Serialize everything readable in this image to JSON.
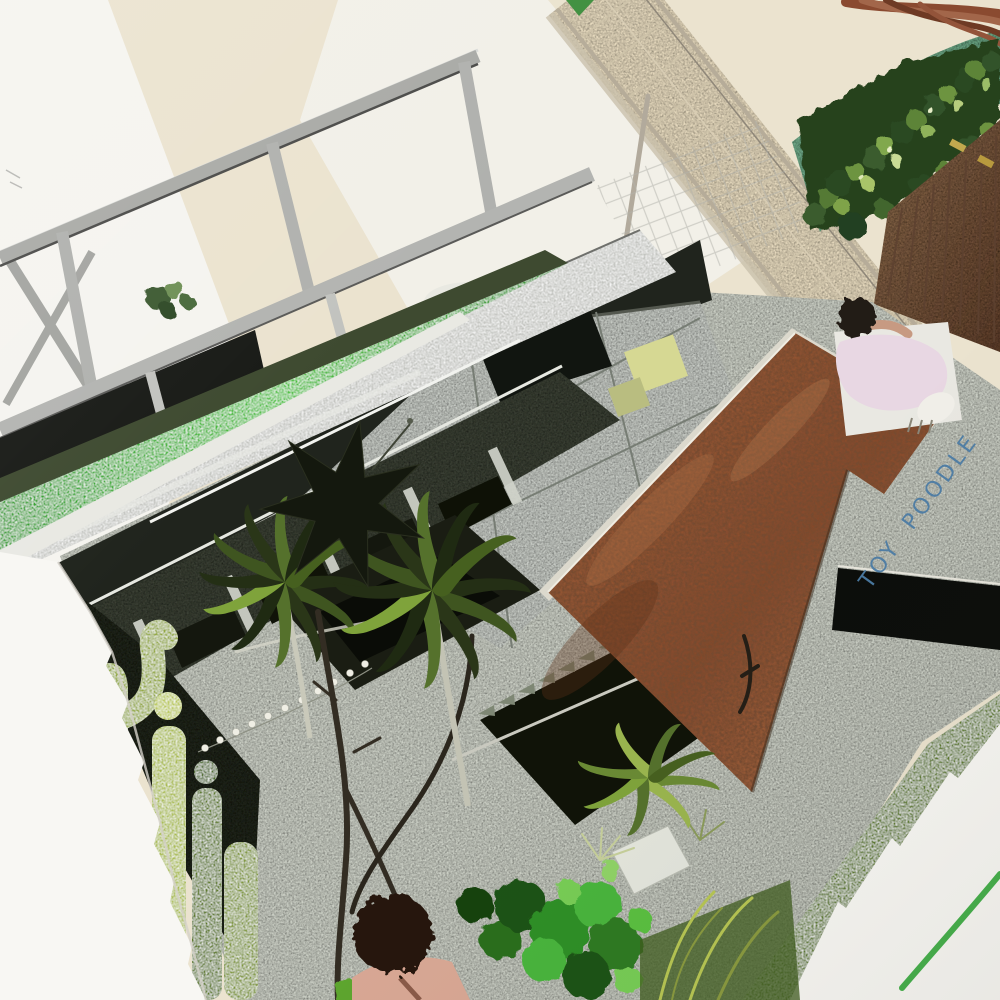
{
  "artwork": {
    "caption": {
      "text": "TOY POODLE",
      "color": "#4d7da6",
      "style": "handwritten blue marker rotated along the concrete path"
    },
    "medium": "photograph of a mixed-media collage painting on deckle-edged watercolor paper",
    "scene": "overhead view of a modernist house courtyard with a copper-rust roof, bright green stripe, steel frame, plants and two figures"
  },
  "figures": {
    "rooftop_figure": "person with dark hair wearing a pale pink shirt",
    "path_figure": "person with dark curly hair seen from above"
  },
  "flora": [
    "agave rosettes",
    "columnar cacti",
    "clipped hedge",
    "green bushes",
    "curved lawn band"
  ],
  "objects": [
    "seven-point star ornament",
    "string of lights",
    "chain-link lattice",
    "timber fence with brass hinges",
    "stone walkway",
    "stairwell with sawtooth steps"
  ],
  "palette": {
    "cream": "#ebe3cf",
    "white_wall": "#f5f4ef",
    "facade": "#f2f1ea",
    "walkway": "#e8dbbf",
    "lawn": "#69a581",
    "hedge": "#27421f",
    "wood": "#7b5238",
    "concrete": "#cbcfc5",
    "glass_deck": "#c6cac4",
    "dark_band": "#20241d",
    "wall_dark": "#3a4036",
    "pit_dark": "#101308",
    "fascia": "#c6c8c3",
    "steel": "#a9aaa6",
    "stripe": "#3eb332",
    "rust": "#96512f",
    "black_band": "#0c0e0b",
    "text_blue": "#4d7da6",
    "pink": "#e8d7e3",
    "skin": "#c79a82",
    "hair": "#241a12",
    "grass": "#5e7b2f",
    "stroke_green": "#47b04c",
    "pane_yellow": "#d6d893",
    "cactus": "#93a83e",
    "cactus_bright": "#a9bb49",
    "star": "#14180e",
    "branch": "#332d23",
    "paper": "#f8f7f3",
    "bush": "#2f8f28",
    "planter": "#e3e5dc",
    "curb": "#dcd9cd",
    "lights": "#efeee4"
  }
}
